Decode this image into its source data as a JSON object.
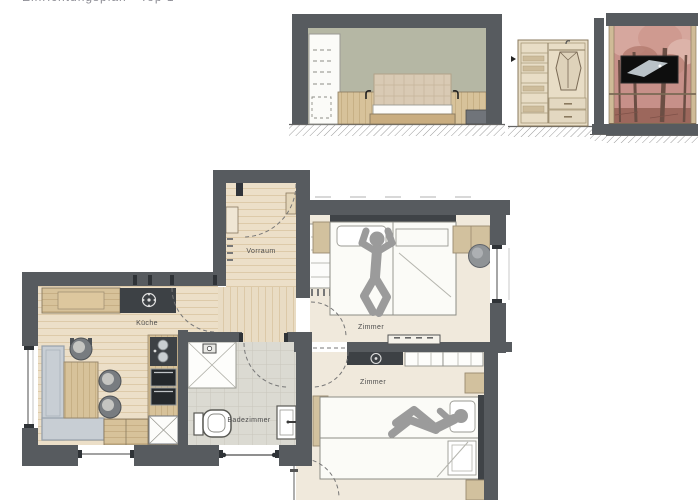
{
  "title": {
    "clipped_text": "Einrichtungsplan · Top 1"
  },
  "floor_plan": {
    "room_labels": {
      "vorraum": "Vorraum",
      "kueche": "Küche",
      "badezimmer": "Badezimmer",
      "zimmer_top": "Zimmer",
      "zimmer_bottom": "Zimmer"
    }
  },
  "colors": {
    "wall": "#575b5f",
    "wood_floor": "#ecdfc8",
    "bedroom_floor": "#f0e9dc",
    "tile_floor": "#dbdad2",
    "furniture_wood": "#d7c29a",
    "dark_counter": "#3d4145",
    "bench_upholstery": "#c8ced4",
    "silhouette_gray": "#9b9b9b",
    "elevation_wall_sage": "#b5b7a4",
    "mural_pink": "#c79089",
    "tv_black": "#0e0e0e"
  }
}
